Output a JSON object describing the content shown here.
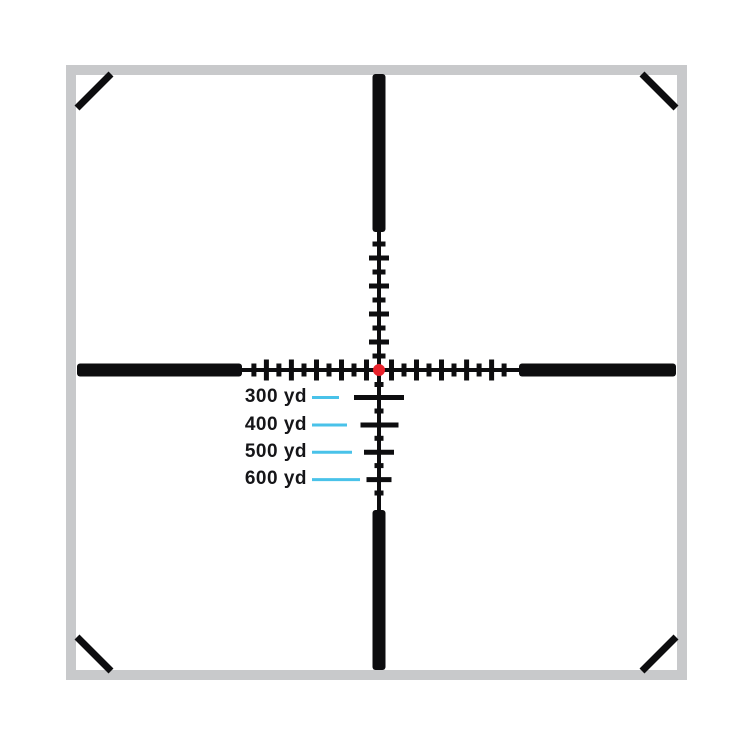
{
  "reticle": {
    "holdovers": [
      {
        "label": "300 yd"
      },
      {
        "label": "400 yd"
      },
      {
        "label": "500 yd"
      },
      {
        "label": "600 yd"
      }
    ],
    "colors": {
      "background": "#ffffff",
      "frame": "#c8c9cb",
      "reticle": "#0d0d0f",
      "center_dot": "#e8212b",
      "leader_line": "#49c2e9",
      "label_text": "#151518"
    }
  }
}
